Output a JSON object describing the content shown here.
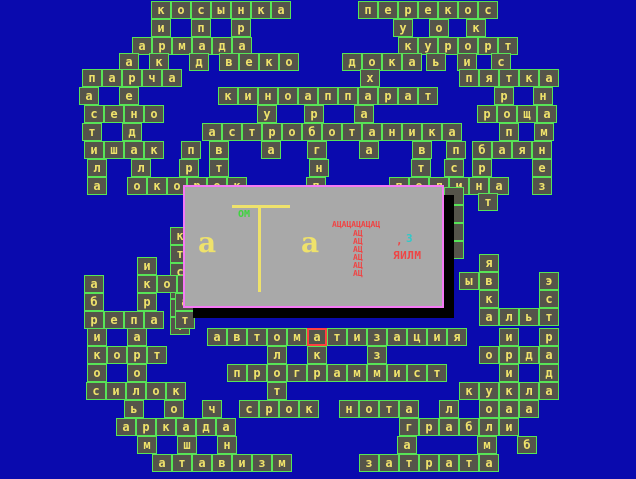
{
  "app": {
    "name": "crossword-game-screen",
    "background": "#0a0aae"
  },
  "palette": {
    "background": "#0a0aae",
    "cell_bg": "#55544a",
    "cell_border": "#57e457",
    "letter": "#efe26b",
    "cursor_border": "#ff4040",
    "dialog_bg": "#a9a9a9",
    "dialog_border": "#f57af5",
    "shadow": "#000000",
    "red_text": "#ef4545",
    "cyan_text": "#2fc9c9",
    "green_text": "#3ed43e"
  },
  "board": {
    "cell_w": 20,
    "cell_h": 18,
    "red_cell": {
      "x": 307,
      "y": 328
    },
    "empty_cells": [
      {
        "x": 444,
        "y": 187
      },
      {
        "x": 444,
        "y": 205
      },
      {
        "x": 444,
        "y": 223
      },
      {
        "x": 444,
        "y": 241
      }
    ],
    "words": [
      {
        "t": "косынка",
        "x": 151,
        "y": 1
      },
      {
        "t": "и",
        "x": 151,
        "y": 19
      },
      {
        "t": "п",
        "x": 191,
        "y": 19
      },
      {
        "t": "р",
        "x": 231,
        "y": 19
      },
      {
        "t": "перекос",
        "x": 358,
        "y": 1
      },
      {
        "t": "у",
        "x": 393,
        "y": 19
      },
      {
        "t": "о",
        "x": 429,
        "y": 19
      },
      {
        "t": "к",
        "x": 466,
        "y": 19
      },
      {
        "t": "армада",
        "x": 132,
        "y": 37
      },
      {
        "t": "курорт",
        "x": 398,
        "y": 37
      },
      {
        "t": "а",
        "x": 119,
        "y": 53
      },
      {
        "t": "к",
        "x": 149,
        "y": 53
      },
      {
        "t": "д",
        "x": 189,
        "y": 53
      },
      {
        "t": "веко",
        "x": 219,
        "y": 53
      },
      {
        "t": "дока",
        "x": 342,
        "y": 53
      },
      {
        "t": "ь",
        "x": 426,
        "y": 53
      },
      {
        "t": "и",
        "x": 457,
        "y": 53
      },
      {
        "t": "с",
        "x": 491,
        "y": 53
      },
      {
        "t": "парча",
        "x": 82,
        "y": 69
      },
      {
        "t": "х",
        "x": 360,
        "y": 69
      },
      {
        "t": "пятка",
        "x": 459,
        "y": 69
      },
      {
        "t": "а",
        "x": 79,
        "y": 87
      },
      {
        "t": "е",
        "x": 119,
        "y": 87
      },
      {
        "t": "киноаппарат",
        "x": 218,
        "y": 87
      },
      {
        "t": "р",
        "x": 494,
        "y": 87
      },
      {
        "t": "н",
        "x": 533,
        "y": 87
      },
      {
        "t": "сено",
        "x": 84,
        "y": 105
      },
      {
        "t": "у",
        "x": 257,
        "y": 105
      },
      {
        "t": "р",
        "x": 304,
        "y": 105
      },
      {
        "t": "а",
        "x": 354,
        "y": 105
      },
      {
        "t": "роща",
        "x": 477,
        "y": 105
      },
      {
        "t": "т",
        "x": 82,
        "y": 123
      },
      {
        "t": "д",
        "x": 122,
        "y": 123
      },
      {
        "t": "астроботаника",
        "x": 202,
        "y": 123
      },
      {
        "t": "п",
        "x": 499,
        "y": 123
      },
      {
        "t": "м",
        "x": 534,
        "y": 123
      },
      {
        "t": "ишак",
        "x": 84,
        "y": 141
      },
      {
        "t": "п",
        "x": 181,
        "y": 141
      },
      {
        "t": "в",
        "x": 209,
        "y": 141
      },
      {
        "t": "а",
        "x": 261,
        "y": 141
      },
      {
        "t": "г",
        "x": 307,
        "y": 141
      },
      {
        "t": "а",
        "x": 359,
        "y": 141
      },
      {
        "t": "в",
        "x": 412,
        "y": 141
      },
      {
        "t": "п",
        "x": 446,
        "y": 141
      },
      {
        "t": "баян",
        "x": 472,
        "y": 141
      },
      {
        "t": "л",
        "x": 87,
        "y": 159
      },
      {
        "t": "л",
        "x": 131,
        "y": 159
      },
      {
        "t": "р",
        "x": 179,
        "y": 159
      },
      {
        "t": "т",
        "x": 209,
        "y": 159
      },
      {
        "t": "н",
        "x": 309,
        "y": 159
      },
      {
        "t": "т",
        "x": 411,
        "y": 159
      },
      {
        "t": "с",
        "x": 444,
        "y": 159
      },
      {
        "t": "р",
        "x": 472,
        "y": 159
      },
      {
        "t": "е",
        "x": 532,
        "y": 159
      },
      {
        "t": "а",
        "x": 87,
        "y": 177
      },
      {
        "t": "окорок",
        "x": 127,
        "y": 177
      },
      {
        "t": "п",
        "x": 306,
        "y": 177
      },
      {
        "t": "полина",
        "x": 389,
        "y": 177
      },
      {
        "t": "з",
        "x": 532,
        "y": 177
      },
      {
        "t": "т",
        "x": 478,
        "y": 193
      },
      {
        "t": "ктсрат",
        "x": 170,
        "y": 227,
        "d": "v"
      },
      {
        "t": "и",
        "x": 137,
        "y": 257
      },
      {
        "t": "а",
        "x": 84,
        "y": 275
      },
      {
        "t": "кор",
        "x": 137,
        "y": 275
      },
      {
        "t": "б",
        "x": 84,
        "y": 293
      },
      {
        "t": "р",
        "x": 137,
        "y": 293
      },
      {
        "t": "а",
        "x": 175,
        "y": 293
      },
      {
        "t": "репа",
        "x": 84,
        "y": 311
      },
      {
        "t": "т",
        "x": 175,
        "y": 311
      },
      {
        "t": "я",
        "x": 479,
        "y": 254
      },
      {
        "t": "ыв",
        "x": 459,
        "y": 272
      },
      {
        "t": "э",
        "x": 539,
        "y": 272
      },
      {
        "t": "к",
        "x": 479,
        "y": 290
      },
      {
        "t": "с",
        "x": 539,
        "y": 290
      },
      {
        "t": "альт",
        "x": 479,
        "y": 308
      },
      {
        "t": "и",
        "x": 87,
        "y": 328
      },
      {
        "t": "а",
        "x": 127,
        "y": 328
      },
      {
        "t": "автоматизация",
        "x": 207,
        "y": 328
      },
      {
        "t": "и",
        "x": 499,
        "y": 328
      },
      {
        "t": "р",
        "x": 539,
        "y": 328
      },
      {
        "t": "корт",
        "x": 87,
        "y": 346
      },
      {
        "t": "л",
        "x": 267,
        "y": 346
      },
      {
        "t": "к",
        "x": 307,
        "y": 346
      },
      {
        "t": "з",
        "x": 367,
        "y": 346
      },
      {
        "t": "орда",
        "x": 479,
        "y": 346
      },
      {
        "t": "о",
        "x": 87,
        "y": 364
      },
      {
        "t": "о",
        "x": 127,
        "y": 364
      },
      {
        "t": "программист",
        "x": 227,
        "y": 364
      },
      {
        "t": "и",
        "x": 499,
        "y": 364
      },
      {
        "t": "д",
        "x": 539,
        "y": 364
      },
      {
        "t": "силок",
        "x": 86,
        "y": 382
      },
      {
        "t": "т",
        "x": 267,
        "y": 382
      },
      {
        "t": "кукла",
        "x": 459,
        "y": 382
      },
      {
        "t": "ь",
        "x": 124,
        "y": 400
      },
      {
        "t": "о",
        "x": 164,
        "y": 400
      },
      {
        "t": "ч",
        "x": 202,
        "y": 400
      },
      {
        "t": "срок",
        "x": 239,
        "y": 400
      },
      {
        "t": "нота",
        "x": 339,
        "y": 400
      },
      {
        "t": "л",
        "x": 439,
        "y": 400
      },
      {
        "t": "о",
        "x": 479,
        "y": 400
      },
      {
        "t": "а",
        "x": 499,
        "y": 400
      },
      {
        "t": "а",
        "x": 519,
        "y": 400
      },
      {
        "t": "аркада",
        "x": 116,
        "y": 418
      },
      {
        "t": "грабли",
        "x": 399,
        "y": 418
      },
      {
        "t": "м",
        "x": 137,
        "y": 436
      },
      {
        "t": "ш",
        "x": 177,
        "y": 436
      },
      {
        "t": "н",
        "x": 217,
        "y": 436
      },
      {
        "t": "а",
        "x": 397,
        "y": 436
      },
      {
        "t": "м",
        "x": 477,
        "y": 436
      },
      {
        "t": "б",
        "x": 517,
        "y": 436
      },
      {
        "t": "атавизм",
        "x": 152,
        "y": 454
      },
      {
        "t": "затрата",
        "x": 359,
        "y": 454
      }
    ]
  },
  "dialog": {
    "x": 183,
    "y": 185,
    "w": 261,
    "h": 123,
    "shadow_right": {
      "x": 444,
      "y": 195,
      "w": 10,
      "h": 123
    },
    "shadow_bottom": {
      "x": 193,
      "y": 308,
      "w": 261,
      "h": 10
    },
    "t_bar_h": {
      "x": 230,
      "y": 203,
      "w": 58,
      "h": 3
    },
    "t_bar_v": {
      "x": 256,
      "y": 203,
      "w": 3,
      "h": 87
    },
    "om_label": "ОМ",
    "big_a_left": "а",
    "big_a_right": "а",
    "red_title": "АЦАЦАЦАЦАЦ",
    "red_stack_text": "АЦ",
    "red_stack_ys": [
      228,
      236,
      244,
      252,
      260,
      268
    ],
    "comma": ",",
    "z_label": "З",
    "yailm_label": "ЯИЛМ"
  }
}
